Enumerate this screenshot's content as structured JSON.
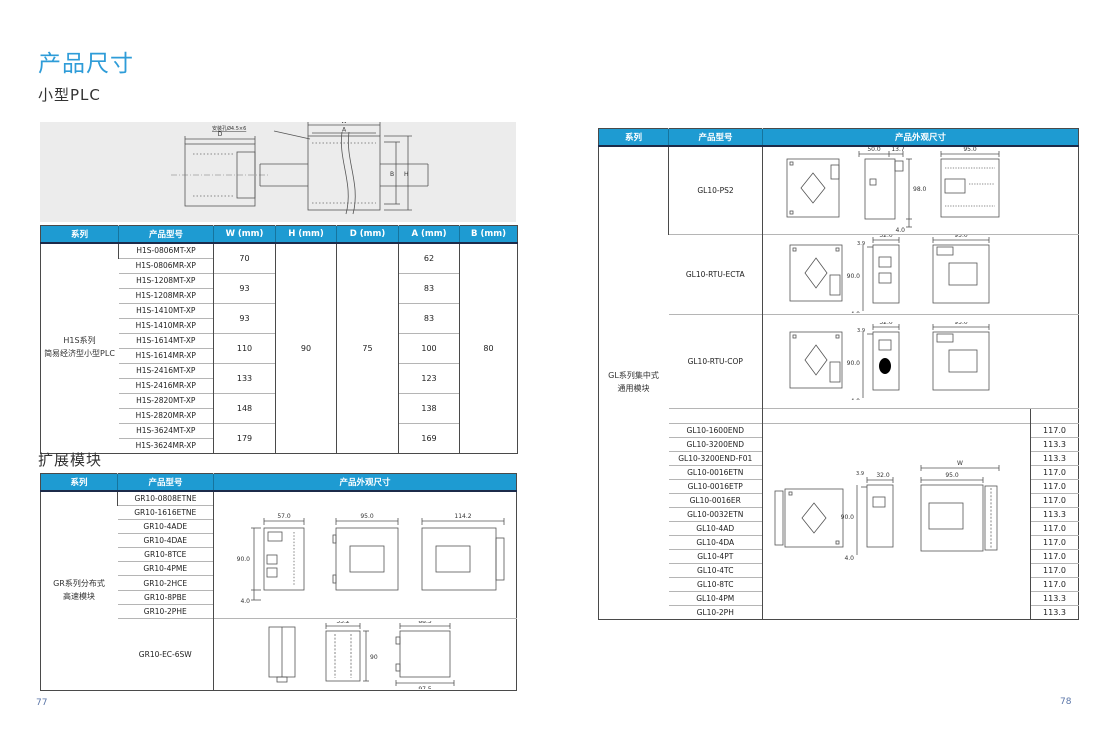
{
  "page": {
    "title": "产品尺寸",
    "section_small_plc": "小型PLC",
    "section_expansion": "扩展模块",
    "page_number_left": "77",
    "page_number_right": "78"
  },
  "colors": {
    "accent_blue": "#1e9bd2",
    "header_underline_navy": "#1c2b4a",
    "title_blue": "#2e9cd8",
    "series_cell_grey": "#ececec"
  },
  "top_diagram": {
    "mount_hole_label": "安装孔Ø4.5×6",
    "dim_d": "D",
    "dim_w": "W",
    "dim_a": "A",
    "dim_b": "B",
    "dim_h": "H"
  },
  "plc_table": {
    "headers": [
      "系列",
      "产品型号",
      "W (mm)",
      "H (mm)",
      "D (mm)",
      "A (mm)",
      "B (mm)"
    ],
    "series_line1": "H1S系列",
    "series_line2": "简易经济型小型PLC",
    "models": [
      "H1S-0806MT-XP",
      "H1S-0806MR-XP",
      "H1S-1208MT-XP",
      "H1S-1208MR-XP",
      "H1S-1410MT-XP",
      "H1S-1410MR-XP",
      "H1S-1614MT-XP",
      "H1S-1614MR-XP",
      "H1S-2416MT-XP",
      "H1S-2416MR-XP",
      "H1S-2820MT-XP",
      "H1S-2820MR-XP",
      "H1S-3624MT-XP",
      "H1S-3624MR-XP"
    ],
    "w_values": [
      "70",
      "93",
      "93",
      "110",
      "133",
      "148",
      "179"
    ],
    "a_values": [
      "62",
      "83",
      "83",
      "100",
      "123",
      "138",
      "169"
    ],
    "h_value": "90",
    "d_value": "75",
    "b_value": "80"
  },
  "gr_table": {
    "headers": [
      "系列",
      "产品型号",
      "产品外观尺寸"
    ],
    "series_line1": "GR系列分布式",
    "series_line2": "高速模块",
    "models": [
      "GR10-0808ETNE",
      "GR10-1616ETNE",
      "GR10-4ADE",
      "GR10-4DAE",
      "GR10-8TCE",
      "GR10-4PME",
      "GR10-2HCE",
      "GR10-8PBE",
      "GR10-2PHE"
    ],
    "last_model": "GR10-EC-6SW",
    "drawing1": {
      "w1": "57.0",
      "w2": "95.0",
      "w3": "114.2",
      "h": "90.0",
      "o": "4.0"
    },
    "drawing2": {
      "w": "53.2",
      "h": "90",
      "top": "88.5",
      "bot": "97.5"
    }
  },
  "gl_table": {
    "headers": [
      "系列",
      "产品型号",
      "产品外观尺寸"
    ],
    "w_header": "W (mm)",
    "series_line1": "GL系列集中式",
    "series_line2": "通用模块",
    "top_models": [
      "GL10-PS2",
      "GL10-RTU-ECTA",
      "GL10-RTU-COP"
    ],
    "rows": [
      {
        "model": "GL10-1600END",
        "w": "117.0"
      },
      {
        "model": "GL10-3200END",
        "w": "113.3"
      },
      {
        "model": "GL10-3200END-F01",
        "w": "113.3"
      },
      {
        "model": "GL10-0016ETN",
        "w": "117.0"
      },
      {
        "model": "GL10-0016ETP",
        "w": "117.0"
      },
      {
        "model": "GL10-0016ER",
        "w": "117.0"
      },
      {
        "model": "GL10-0032ETN",
        "w": "113.3"
      },
      {
        "model": "GL10-4AD",
        "w": "117.0"
      },
      {
        "model": "GL10-4DA",
        "w": "117.0"
      },
      {
        "model": "GL10-4PT",
        "w": "117.0"
      },
      {
        "model": "GL10-4TC",
        "w": "117.0"
      },
      {
        "model": "GL10-8TC",
        "w": "117.0"
      },
      {
        "model": "GL10-4PM",
        "w": "113.3"
      },
      {
        "model": "GL10-2PH",
        "w": "113.3"
      }
    ],
    "drawing_ps2": {
      "a": "50.0",
      "b": "13.7",
      "w": "95.0",
      "h": "98.0",
      "o": "4.0"
    },
    "drawing_rtu": {
      "a": "3.9",
      "b": "32.0",
      "w": "95.0",
      "h": "90.0",
      "o": "4.0"
    },
    "drawing_w": {
      "W": "W",
      "w": "95.0",
      "a": "3.9",
      "b": "32.0",
      "h": "90.0",
      "o": "4.0"
    }
  }
}
